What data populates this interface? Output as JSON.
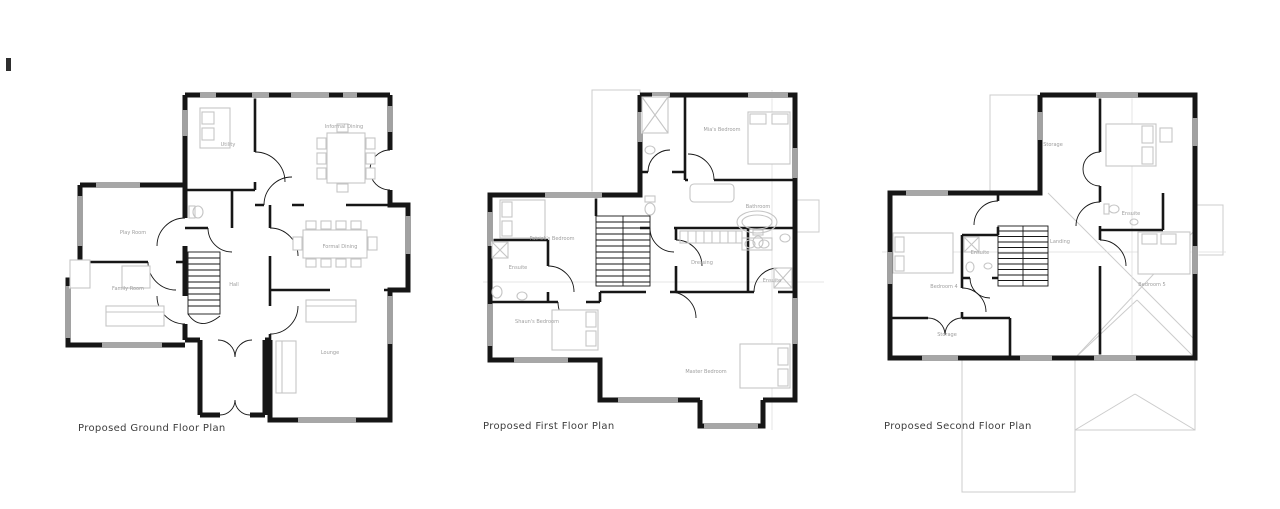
{
  "sheet": {
    "background": "#ffffff"
  },
  "colors": {
    "background": "#ffffff",
    "wall": "#161616",
    "furniture": "#c5c5c5",
    "roof": "#cccccc",
    "grid": "#dedede",
    "label": "#9e9e9e",
    "caption": "#3d3d3d"
  },
  "plans": [
    {
      "id": "ground-floor",
      "caption": "Proposed Ground Floor Plan",
      "rooms": [
        {
          "name": "Utility"
        },
        {
          "name": "Informal Dining"
        },
        {
          "name": "Play Room"
        },
        {
          "name": "Formal Dining"
        },
        {
          "name": "Family Room"
        },
        {
          "name": "Hall"
        },
        {
          "name": "Lounge"
        }
      ]
    },
    {
      "id": "first-floor",
      "caption": "Proposed First Floor Plan",
      "rooms": [
        {
          "name": "Mia's Bedroom"
        },
        {
          "name": "Bathroom"
        },
        {
          "name": "Patrick's Bedroom"
        },
        {
          "name": "Ensuite"
        },
        {
          "name": "Dressing"
        },
        {
          "name": "Ensuite"
        },
        {
          "name": "Shaun's Bedroom"
        },
        {
          "name": "Master Bedroom"
        }
      ]
    },
    {
      "id": "second-floor",
      "caption": "Proposed Second Floor Plan",
      "rooms": [
        {
          "name": "Storage"
        },
        {
          "name": "Ensuite"
        },
        {
          "name": "Landing"
        },
        {
          "name": "Ensuite"
        },
        {
          "name": "Bedroom 4"
        },
        {
          "name": "Bedroom 5"
        },
        {
          "name": "Storage"
        }
      ]
    }
  ]
}
